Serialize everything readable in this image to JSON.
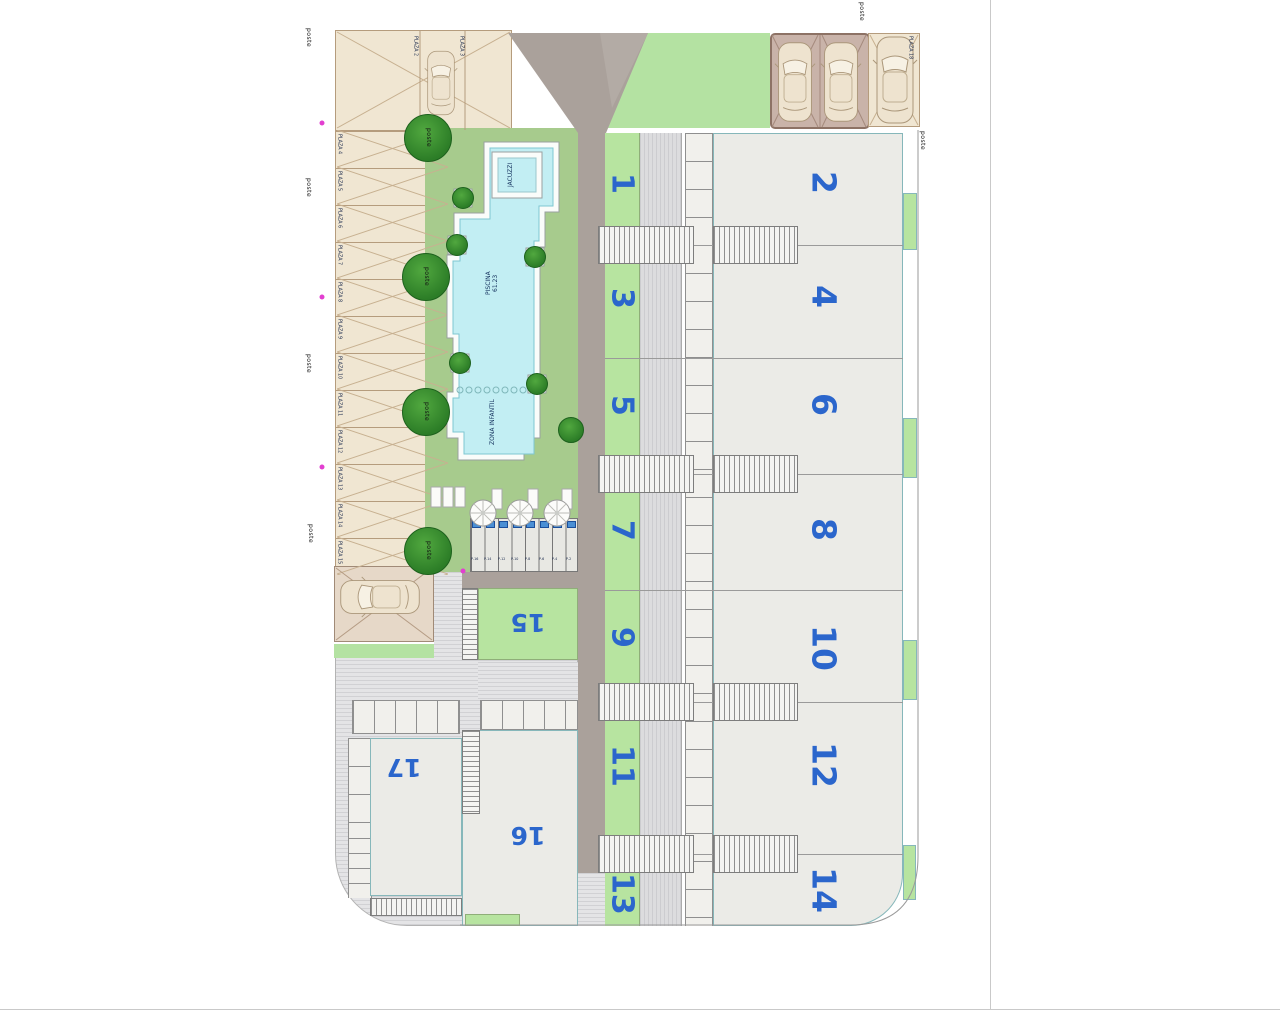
{
  "labels": {
    "poste": "poste"
  },
  "parking": {
    "top_left": [
      "PLAZA 2",
      "PLAZA 3"
    ],
    "left": [
      "PLAZA 4",
      "PLAZA 5",
      "PLAZA 6",
      "PLAZA 7",
      "PLAZA 8",
      "PLAZA 9",
      "PLAZA 10",
      "PLAZA 11",
      "PLAZA 12",
      "PLAZA 13",
      "PLAZA 14",
      "PLAZA 15"
    ],
    "top_right": "PLAZA 18",
    "small_row": [
      "P-16",
      "P-14",
      "P-12",
      "P-10",
      "P-8",
      "P-6",
      "P-4",
      "P-2"
    ]
  },
  "pool": {
    "jacuzzi": "JACUZZI",
    "name": "PISCINA",
    "area": "61.23",
    "kids_zone": "ZONA INFANTIL"
  },
  "units": {
    "odd": [
      "1",
      "3",
      "5",
      "7",
      "9",
      "11",
      "13"
    ],
    "even": [
      "2",
      "4",
      "6",
      "8",
      "10",
      "12",
      "14"
    ],
    "lower": [
      "15",
      "16",
      "17"
    ]
  },
  "icons": {
    "tree": "tree-icon",
    "car": "car-icon",
    "parasol": "parasol-icon",
    "lounger": "lounger-icon",
    "post_marker": "post-marker-icon",
    "stairs": "stairs-icon"
  },
  "colors": {
    "unit_number_blue": "#2b66cc",
    "garden_green": "#a7cb8d",
    "strip_green": "#b7e4a0",
    "lawn_green": "#b4e2a2",
    "road_taupe": "#aaa19b",
    "pool_water": "#c2eef3",
    "canopy_beige": "#f0e6d2",
    "canopy_mauve": "#c9b3a9",
    "paving_gray": "#e4e4e6",
    "tree_green": "#2c7d27",
    "post_magenta": "#e23fd0"
  }
}
